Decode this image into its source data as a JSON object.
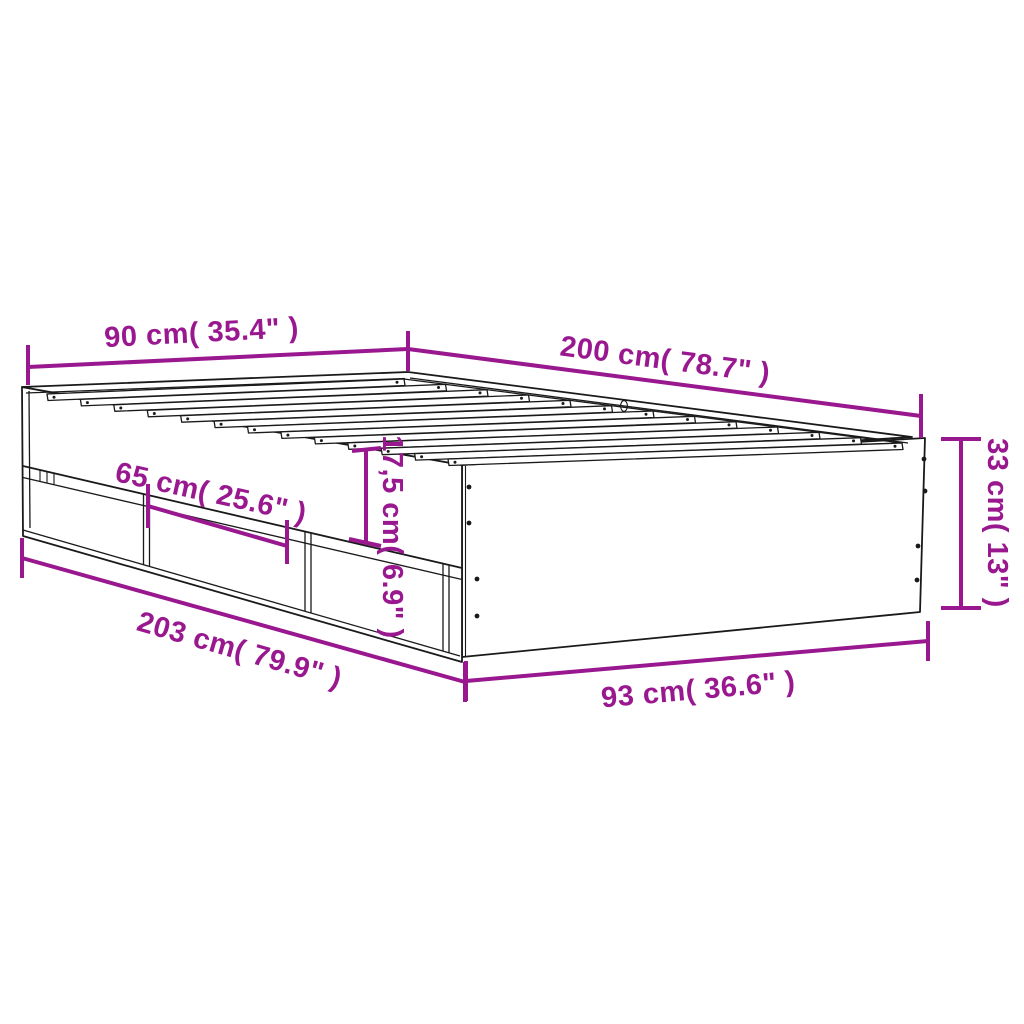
{
  "diagram": {
    "type": "product-dimension-diagram",
    "product": "bed-frame-with-drawers",
    "colors": {
      "dimension": "#99188F",
      "line": "#1a1a1a",
      "background": "#ffffff"
    },
    "dimensions": {
      "head_width": {
        "label": "90 cm( 35.4\" )"
      },
      "top_length": {
        "label": "200 cm( 78.7\" )"
      },
      "foot_height": {
        "label": "33 cm( 13\" )"
      },
      "drawer_width": {
        "label": "65 cm( 25.6\" )"
      },
      "drawer_height": {
        "label": "17,5 cm( 6.9\" )"
      },
      "overall_length": {
        "label": "203 cm( 79.9\" )"
      },
      "foot_width": {
        "label": "93 cm( 36.6\" )"
      }
    }
  }
}
